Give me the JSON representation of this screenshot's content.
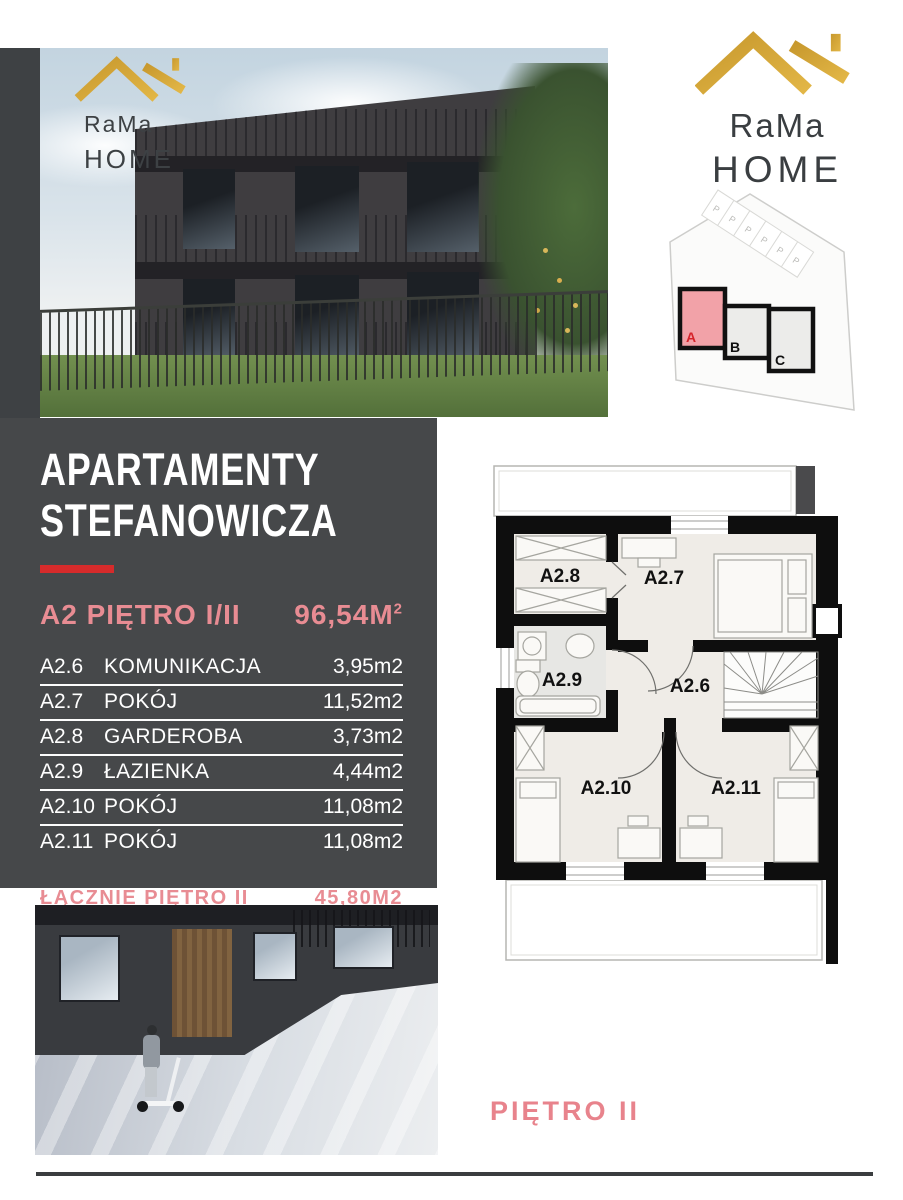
{
  "brand": {
    "line1": "RaMa",
    "line2": "HOME",
    "gold": "#d7a73a",
    "text_color": "#3a3e41"
  },
  "site_plan": {
    "parking_label": "P",
    "blocks": [
      {
        "label": "A",
        "highlighted": true
      },
      {
        "label": "B",
        "highlighted": false
      },
      {
        "label": "C",
        "highlighted": false
      }
    ],
    "highlight_fill": "#f2a2a8",
    "highlight_label_color": "#d6232a"
  },
  "panel": {
    "bg": "#46484a",
    "accent_red": "#d62b2b",
    "accent_pink": "#e88c93",
    "title_line1": "APARTAMENTY",
    "title_line2": "STEFANOWICZA",
    "unit_label": "A2 PIĘTRO I/II",
    "area_value": "96,54M",
    "area_sup": "2",
    "rooms": [
      {
        "code": "A2.6",
        "name": "KOMUNIKACJA",
        "area": "3,95m2"
      },
      {
        "code": "A2.7",
        "name": "POKÓJ",
        "area": "11,52m2"
      },
      {
        "code": "A2.8",
        "name": "GARDEROBA",
        "area": "3,73m2"
      },
      {
        "code": "A2.9",
        "name": "ŁAZIENKA",
        "area": "4,44m2"
      },
      {
        "code": "A2.10",
        "name": "POKÓJ",
        "area": "11,08m2"
      },
      {
        "code": "A2.11",
        "name": "POKÓJ",
        "area": "11,08m2"
      }
    ],
    "total_label": "ŁĄCZNIE PIĘTRO II",
    "total_value": "45,80M2"
  },
  "floor_plan": {
    "caption": "PIĘTRO II",
    "rooms": [
      {
        "id": "A2.8"
      },
      {
        "id": "A2.7"
      },
      {
        "id": "A2.9"
      },
      {
        "id": "A2.6"
      },
      {
        "id": "A2.10"
      },
      {
        "id": "A2.11"
      }
    ]
  }
}
